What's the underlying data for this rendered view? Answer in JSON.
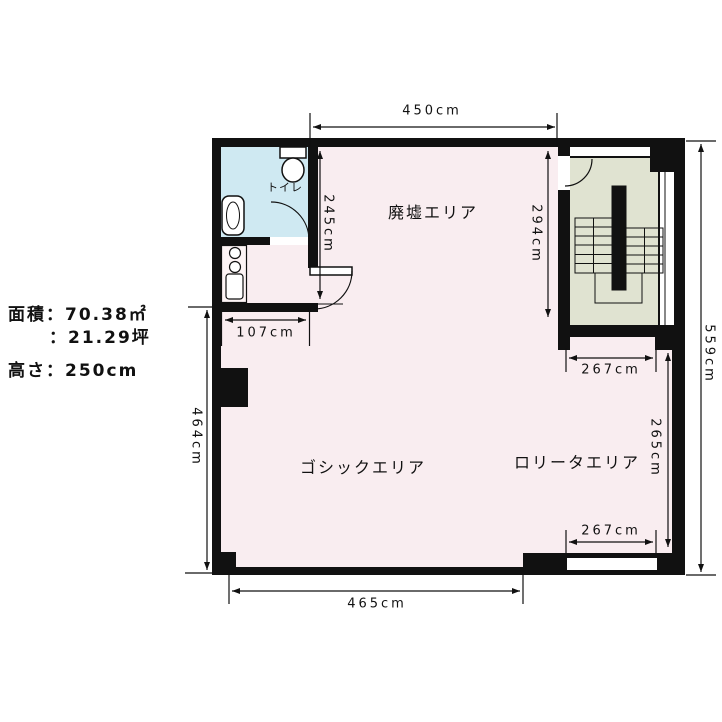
{
  "info_panel": {
    "area_line1": "面積：70.38㎡",
    "area_line2": "：21.29坪",
    "height_line": "高さ：250cm"
  },
  "rooms": {
    "ruins_area": "廃墟エリア",
    "gothic_area": "ゴシックエリア",
    "lolita_area": "ロリータエリア",
    "toilet": "トイレ"
  },
  "dims": {
    "top_width": "450cm",
    "west_inner_height": "245cm",
    "stairwell_height": "294cm",
    "east_total_height": "559cm",
    "stair_opening_width": "267cm",
    "lolita_height": "265cm",
    "lolita_bottom_width": "267cm",
    "kitchen_width": "107cm",
    "west_wall_height": "464cm",
    "bottom_width": "465cm"
  },
  "colors": {
    "wall": "#111111",
    "floor_main": "#f9edf0",
    "floor_toilet": "#cfe9f2",
    "floor_stairwell": "#e0e3d1",
    "background": "#ffffff"
  }
}
